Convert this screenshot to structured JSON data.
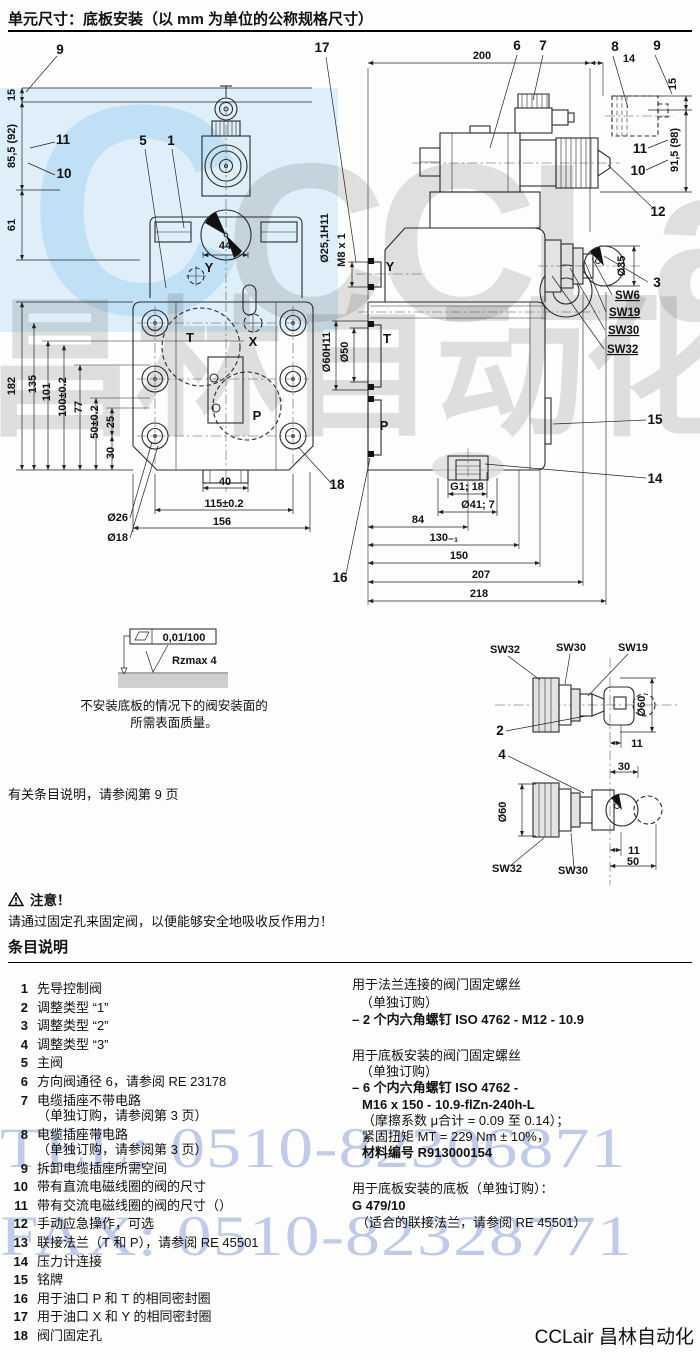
{
  "title": "单元尺寸：底板安装（以 mm 为单位的公称规格尺寸）",
  "notes": {
    "ref": "有关条目说明，请参阅第 9 页",
    "warn_title": "注意！",
    "warn_text": "请通过固定孔来固定阀，以便能够安全地吸收反作用力！"
  },
  "items_section": {
    "heading": "条目说明",
    "items": [
      {
        "n": "1",
        "l1": "先导控制阀"
      },
      {
        "n": "2",
        "l1": "调整类型 “1”"
      },
      {
        "n": "3",
        "l1": "调整类型 “2”"
      },
      {
        "n": "4",
        "l1": "调整类型 “3”"
      },
      {
        "n": "5",
        "l1": "主阀"
      },
      {
        "n": "6",
        "l1": "方向阀通径 6，请参阅 RE 23178"
      },
      {
        "n": "7",
        "l1": "电缆插座不带电路",
        "l2": "（单独订购，请参阅第 3 页）"
      },
      {
        "n": "8",
        "l1": "电缆插座带电路",
        "l2": "（单独订购，请参阅第 3 页）"
      },
      {
        "n": "9",
        "l1": "拆卸电缆插座所需空间"
      },
      {
        "n": "10",
        "l1": "带有直流电磁线圈的阀的尺寸"
      },
      {
        "n": "11",
        "l1": "带有交流电磁线圈的阀的尺寸（）"
      },
      {
        "n": "12",
        "l1": "手动应急操作，可选"
      },
      {
        "n": "13",
        "l1": "联接法兰（T 和 P），请参阅 RE 45501"
      },
      {
        "n": "14",
        "l1": "压力计连接"
      },
      {
        "n": "15",
        "l1": "铭牌"
      },
      {
        "n": "16",
        "l1": "用于油口 P 和 T 的相同密封圈"
      },
      {
        "n": "17",
        "l1": "用于油口 X 和 Y 的相同密封圈"
      },
      {
        "n": "18",
        "l1": "阀门固定孔"
      }
    ],
    "right_blocks": [
      {
        "lines": [
          {
            "t": "用于法兰连接的阀门固定螺丝"
          },
          {
            "t": "（单独订购）",
            "i": 8
          },
          {
            "t": "– 2 个内六角螺钉 ISO 4762 - M12 - 10.9",
            "b": true
          }
        ]
      },
      {
        "lines": [
          {
            "t": "用于底板安装的阀门固定螺丝"
          },
          {
            "t": "（单独订购）",
            "i": 8
          },
          {
            "t": "– 6 个内六角螺钉 ISO 4762 -",
            "b": true
          },
          {
            "t": "M16 x 150 - 10.9-flZn-240h-L",
            "b": true,
            "i": 10
          },
          {
            "t": "（摩擦系数 μ合计 = 0.09 至 0.14）；",
            "i": 10
          },
          {
            "t": "紧固扭矩 MT = 229 Nm ± 10%，",
            "i": 10
          },
          {
            "t": "材料编号 R913000154",
            "b": true,
            "i": 10
          }
        ]
      },
      {
        "lines": [
          {
            "t": "用于底板安装的底板（单独订购）："
          },
          {
            "t": "G 479/10",
            "b": true
          },
          {
            "t": "（适合的联接法兰，请参阅 RE 45501）",
            "i": 4
          }
        ]
      }
    ]
  },
  "watermark": {
    "tel": "TEL: 0510-82306871",
    "fax": "FAX: 0510-82328771",
    "c": "C",
    "row1": "CCLair",
    "row2": "昌林自动化",
    "blue": "#8fa3dc",
    "band": "#d3eaf9"
  },
  "footer": {
    "logo": "CCLair 昌林自动化"
  },
  "drawing": {
    "labels": [
      {
        "k": "co",
        "t": "9",
        "x": 60,
        "y": 54
      },
      {
        "k": "co",
        "t": "17",
        "x": 322,
        "y": 52
      },
      {
        "k": "co",
        "t": "11",
        "x": 63,
        "y": 144
      },
      {
        "k": "co",
        "t": "10",
        "x": 64,
        "y": 178
      },
      {
        "k": "co",
        "t": "5",
        "x": 143,
        "y": 145
      },
      {
        "k": "co",
        "t": "1",
        "x": 171,
        "y": 145
      },
      {
        "k": "co",
        "t": "18",
        "x": 337,
        "y": 489
      },
      {
        "k": "dim",
        "t": "15",
        "x": 15,
        "y": 95,
        "r": -90
      },
      {
        "k": "dim",
        "t": "85,5 (92)",
        "x": 15,
        "y": 146,
        "r": -90
      },
      {
        "k": "dim",
        "t": "61",
        "x": 15,
        "y": 225,
        "r": -90
      },
      {
        "k": "dim",
        "t": "182",
        "x": 15,
        "y": 386,
        "r": -90
      },
      {
        "k": "dim",
        "t": "135",
        "x": 36,
        "y": 384,
        "r": -90
      },
      {
        "k": "dim",
        "t": "101",
        "x": 50,
        "y": 392,
        "r": -90
      },
      {
        "k": "dim",
        "t": "100±0.2",
        "x": 66,
        "y": 397,
        "r": -90
      },
      {
        "k": "dim",
        "t": "77",
        "x": 82,
        "y": 407,
        "r": -90
      },
      {
        "k": "dim",
        "t": "50±0.2",
        "x": 98,
        "y": 422,
        "r": -90
      },
      {
        "k": "dim",
        "t": "25",
        "x": 114,
        "y": 422,
        "r": -90
      },
      {
        "k": "dim",
        "t": "30",
        "x": 114,
        "y": 453,
        "r": -90
      },
      {
        "k": "dim",
        "t": "44",
        "x": 225,
        "y": 249
      },
      {
        "k": "dim",
        "t": "40",
        "x": 225,
        "y": 485
      },
      {
        "k": "dim",
        "t": "115±0.2",
        "x": 224,
        "y": 507
      },
      {
        "k": "dim",
        "t": "156",
        "x": 222,
        "y": 525
      },
      {
        "k": "dim",
        "t": "Ø26",
        "x": 128,
        "y": 521,
        "a": "e"
      },
      {
        "k": "dim",
        "t": "Ø18",
        "x": 128,
        "y": 541,
        "a": "e"
      },
      {
        "k": "port",
        "t": "Y",
        "x": 209,
        "y": 272
      },
      {
        "k": "port",
        "t": "T",
        "x": 190,
        "y": 342
      },
      {
        "k": "port",
        "t": "X",
        "x": 253,
        "y": 346
      },
      {
        "k": "port",
        "t": "P",
        "x": 257,
        "y": 420
      },
      {
        "k": "co",
        "t": "6",
        "x": 517,
        "y": 50
      },
      {
        "k": "co",
        "t": "7",
        "x": 543,
        "y": 50
      },
      {
        "k": "co",
        "t": "8",
        "x": 615,
        "y": 51
      },
      {
        "k": "co",
        "t": "9",
        "x": 657,
        "y": 50
      },
      {
        "k": "dim",
        "t": "200",
        "x": 482,
        "y": 59
      },
      {
        "k": "dim",
        "t": "14",
        "x": 629,
        "y": 62
      },
      {
        "k": "dim",
        "t": "15",
        "x": 676,
        "y": 84,
        "r": -90
      },
      {
        "k": "dim",
        "t": "91,5 (98)",
        "x": 678,
        "y": 150,
        "r": -90
      },
      {
        "k": "co",
        "t": "11",
        "x": 640,
        "y": 153
      },
      {
        "k": "co",
        "t": "10",
        "x": 638,
        "y": 175
      },
      {
        "k": "co",
        "t": "12",
        "x": 658,
        "y": 216
      },
      {
        "k": "dim",
        "t": "Ø35",
        "x": 625,
        "y": 266,
        "r": -90
      },
      {
        "k": "co",
        "t": "3",
        "x": 657,
        "y": 287
      },
      {
        "k": "sw",
        "t": "SW6",
        "x": 615,
        "y": 299,
        "a": "s"
      },
      {
        "k": "sw",
        "t": "SW19",
        "x": 609,
        "y": 316,
        "a": "s"
      },
      {
        "k": "sw",
        "t": "SW30",
        "x": 608,
        "y": 334,
        "a": "s"
      },
      {
        "k": "sw",
        "t": "SW32",
        "x": 607,
        "y": 353,
        "a": "s"
      },
      {
        "k": "co",
        "t": "15",
        "x": 655,
        "y": 424
      },
      {
        "k": "co",
        "t": "14",
        "x": 655,
        "y": 483
      },
      {
        "k": "dim",
        "t": "G1; 18",
        "x": 467,
        "y": 490
      },
      {
        "k": "dim",
        "t": "Ø41; 7",
        "x": 478,
        "y": 508
      },
      {
        "k": "dim",
        "t": "84",
        "x": 418,
        "y": 523
      },
      {
        "k": "dim",
        "t": "130₋₁",
        "x": 444,
        "y": 541
      },
      {
        "k": "dim",
        "t": "150",
        "x": 459,
        "y": 559
      },
      {
        "k": "dim",
        "t": "207",
        "x": 481,
        "y": 578
      },
      {
        "k": "dim",
        "t": "218",
        "x": 479,
        "y": 597
      },
      {
        "k": "co",
        "t": "16",
        "x": 340,
        "y": 582
      },
      {
        "k": "port",
        "t": "Y",
        "x": 390,
        "y": 271
      },
      {
        "k": "port",
        "t": "T",
        "x": 387,
        "y": 343
      },
      {
        "k": "port",
        "t": "P",
        "x": 384,
        "y": 430
      },
      {
        "k": "dim",
        "t": "Ø25,1H11",
        "x": 328,
        "y": 238,
        "r": -90
      },
      {
        "k": "dim",
        "t": "M8 x 1",
        "x": 345,
        "y": 250,
        "r": -90
      },
      {
        "k": "dim",
        "t": "Ø60H11",
        "x": 330,
        "y": 352,
        "r": -90
      },
      {
        "k": "dim",
        "t": "Ø50",
        "x": 348,
        "y": 352,
        "r": -90
      },
      {
        "k": "dim",
        "t": "SW32",
        "x": 490,
        "y": 653,
        "a": "s"
      },
      {
        "k": "dim",
        "t": "SW30",
        "x": 556,
        "y": 651,
        "a": "s"
      },
      {
        "k": "dim",
        "t": "SW19",
        "x": 618,
        "y": 651,
        "a": "s"
      },
      {
        "k": "co",
        "t": "2",
        "x": 500,
        "y": 735
      },
      {
        "k": "co",
        "t": "4",
        "x": 502,
        "y": 759
      },
      {
        "k": "dim",
        "t": "Ø60",
        "x": 645,
        "y": 706,
        "r": -90
      },
      {
        "k": "dim",
        "t": "11",
        "x": 637,
        "y": 747
      },
      {
        "k": "dim",
        "t": "30",
        "x": 624,
        "y": 770
      },
      {
        "k": "dim",
        "t": "Ø60",
        "x": 506,
        "y": 812,
        "r": -90
      },
      {
        "k": "dim",
        "t": "11",
        "x": 634,
        "y": 854
      },
      {
        "k": "dim",
        "t": "50",
        "x": 633,
        "y": 865
      },
      {
        "k": "dim",
        "t": "SW32",
        "x": 492,
        "y": 872,
        "a": "s"
      },
      {
        "k": "dim",
        "t": "SW30",
        "x": 558,
        "y": 874,
        "a": "s"
      },
      {
        "k": "dim",
        "t": "0,01/100",
        "x": 184,
        "y": 641
      },
      {
        "k": "dim",
        "t": "Rzmax 4",
        "x": 172,
        "y": 664,
        "a": "s"
      },
      {
        "k": "note",
        "t": "不安装底板的情况下的阀安装面的",
        "x": 174,
        "y": 710
      },
      {
        "k": "note",
        "t": "所需表面质量。",
        "x": 174,
        "y": 727
      }
    ]
  }
}
